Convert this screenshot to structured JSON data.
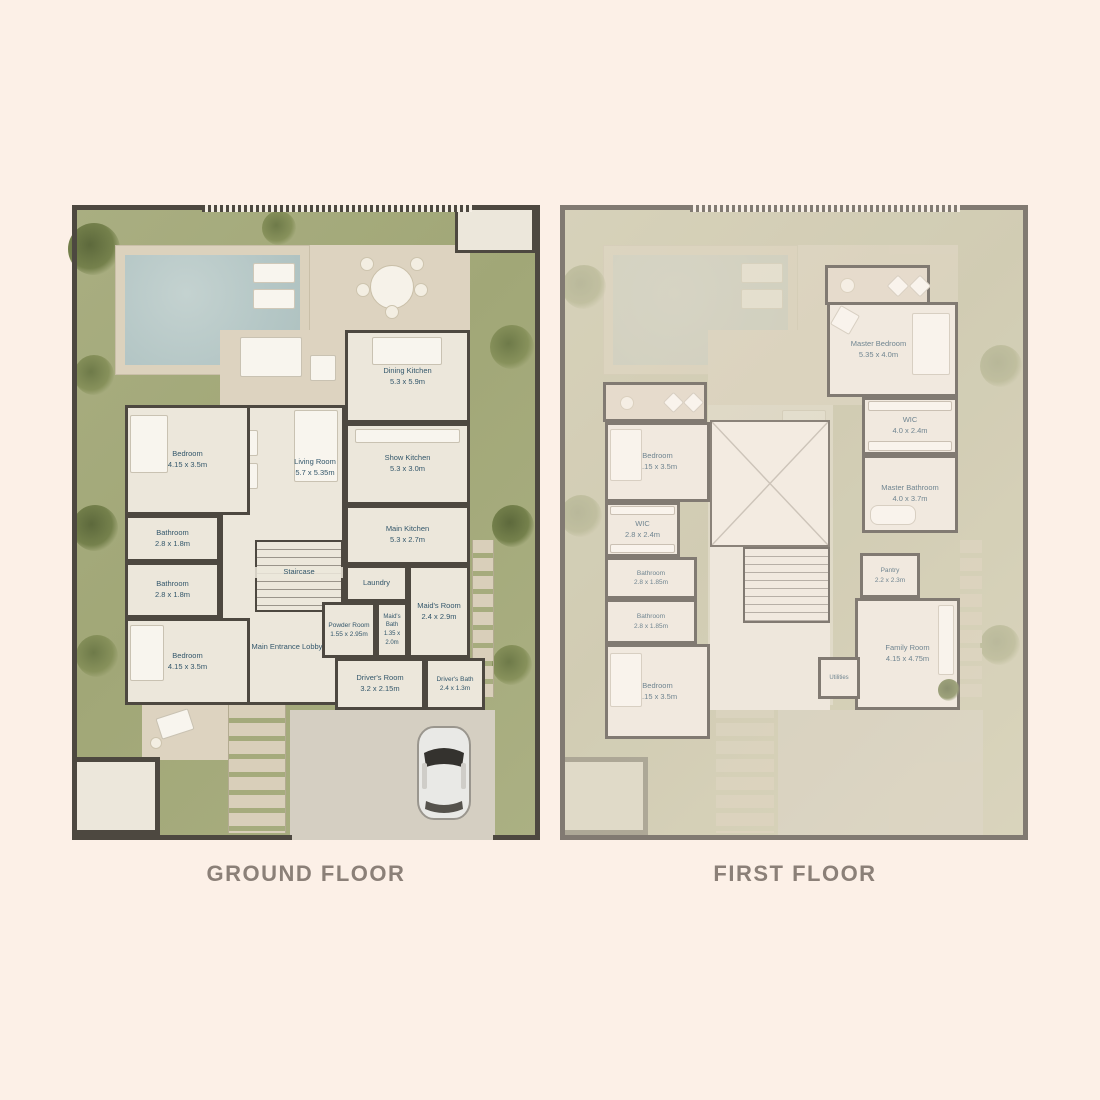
{
  "titles": {
    "ground": "GROUND FLOOR",
    "first": "FIRST FLOOR"
  },
  "colors": {
    "background": "#fcf0e7",
    "title_text": "#8b8078",
    "wall": "#4d4840",
    "room_floor": "#ece7db",
    "garden": "#a5aa7d",
    "garden_faded": "#c4c2a3",
    "pool_water": "#b5c7c6",
    "deck": "#dcd2bd",
    "room_label": "#33576b",
    "driveway": "#d5cfc2"
  },
  "ground": {
    "rooms": {
      "dining_kitchen": {
        "name": "Dining Kitchen",
        "dims": "5.3 x 5.9m"
      },
      "show_kitchen": {
        "name": "Show Kitchen",
        "dims": "5.3 x 3.0m"
      },
      "living_room": {
        "name": "Living Room",
        "dims": "5.7 x 5.35m"
      },
      "bedroom_top": {
        "name": "Bedroom",
        "dims": "4.15 x 3.5m"
      },
      "bathroom_top": {
        "name": "Bathroom",
        "dims": "2.8 x 1.8m"
      },
      "bathroom_bottom": {
        "name": "Bathroom",
        "dims": "2.8 x 1.8m"
      },
      "bedroom_bottom": {
        "name": "Bedroom",
        "dims": "4.15 x 3.5m"
      },
      "main_kitchen": {
        "name": "Main Kitchen",
        "dims": "5.3 x 2.7m"
      },
      "laundry": {
        "name": "Laundry",
        "dims": ""
      },
      "maids_room": {
        "name": "Maid's Room",
        "dims": "2.4 x 2.9m"
      },
      "maids_bath": {
        "name": "Maid's Bath",
        "dims": "1.35 x 2.0m"
      },
      "powder_room": {
        "name": "Powder Room",
        "dims": "1.55 x 2.95m"
      },
      "staircase": {
        "name": "Staircase",
        "dims": ""
      },
      "lobby": {
        "name": "Main Entrance Lobby",
        "dims": ""
      },
      "drivers_room": {
        "name": "Driver's Room",
        "dims": "3.2 x 2.15m"
      },
      "drivers_bath": {
        "name": "Driver's Bath",
        "dims": "2.4 x 1.3m"
      }
    }
  },
  "first": {
    "rooms": {
      "master_bedroom": {
        "name": "Master Bedroom",
        "dims": "5.35 x 4.0m"
      },
      "wic_master": {
        "name": "WIC",
        "dims": "4.0 x 2.4m"
      },
      "master_bathroom": {
        "name": "Master Bathroom",
        "dims": "4.0 x 3.7m"
      },
      "bedroom_top": {
        "name": "Bedroom",
        "dims": "4.15 x 3.5m"
      },
      "wic": {
        "name": "WIC",
        "dims": "2.8 x 2.4m"
      },
      "bathroom_top": {
        "name": "Bathroom",
        "dims": "2.8 x 1.85m"
      },
      "bathroom_bottom": {
        "name": "Bathroom",
        "dims": "2.8 x 1.85m"
      },
      "bedroom_bottom": {
        "name": "Bedroom",
        "dims": "4.15 x 3.5m"
      },
      "pantry": {
        "name": "Pantry",
        "dims": "2.2 x 2.3m"
      },
      "family_room": {
        "name": "Family Room",
        "dims": "4.15 x 4.75m"
      },
      "utilities": {
        "name": "Utilities",
        "dims": ""
      }
    }
  }
}
